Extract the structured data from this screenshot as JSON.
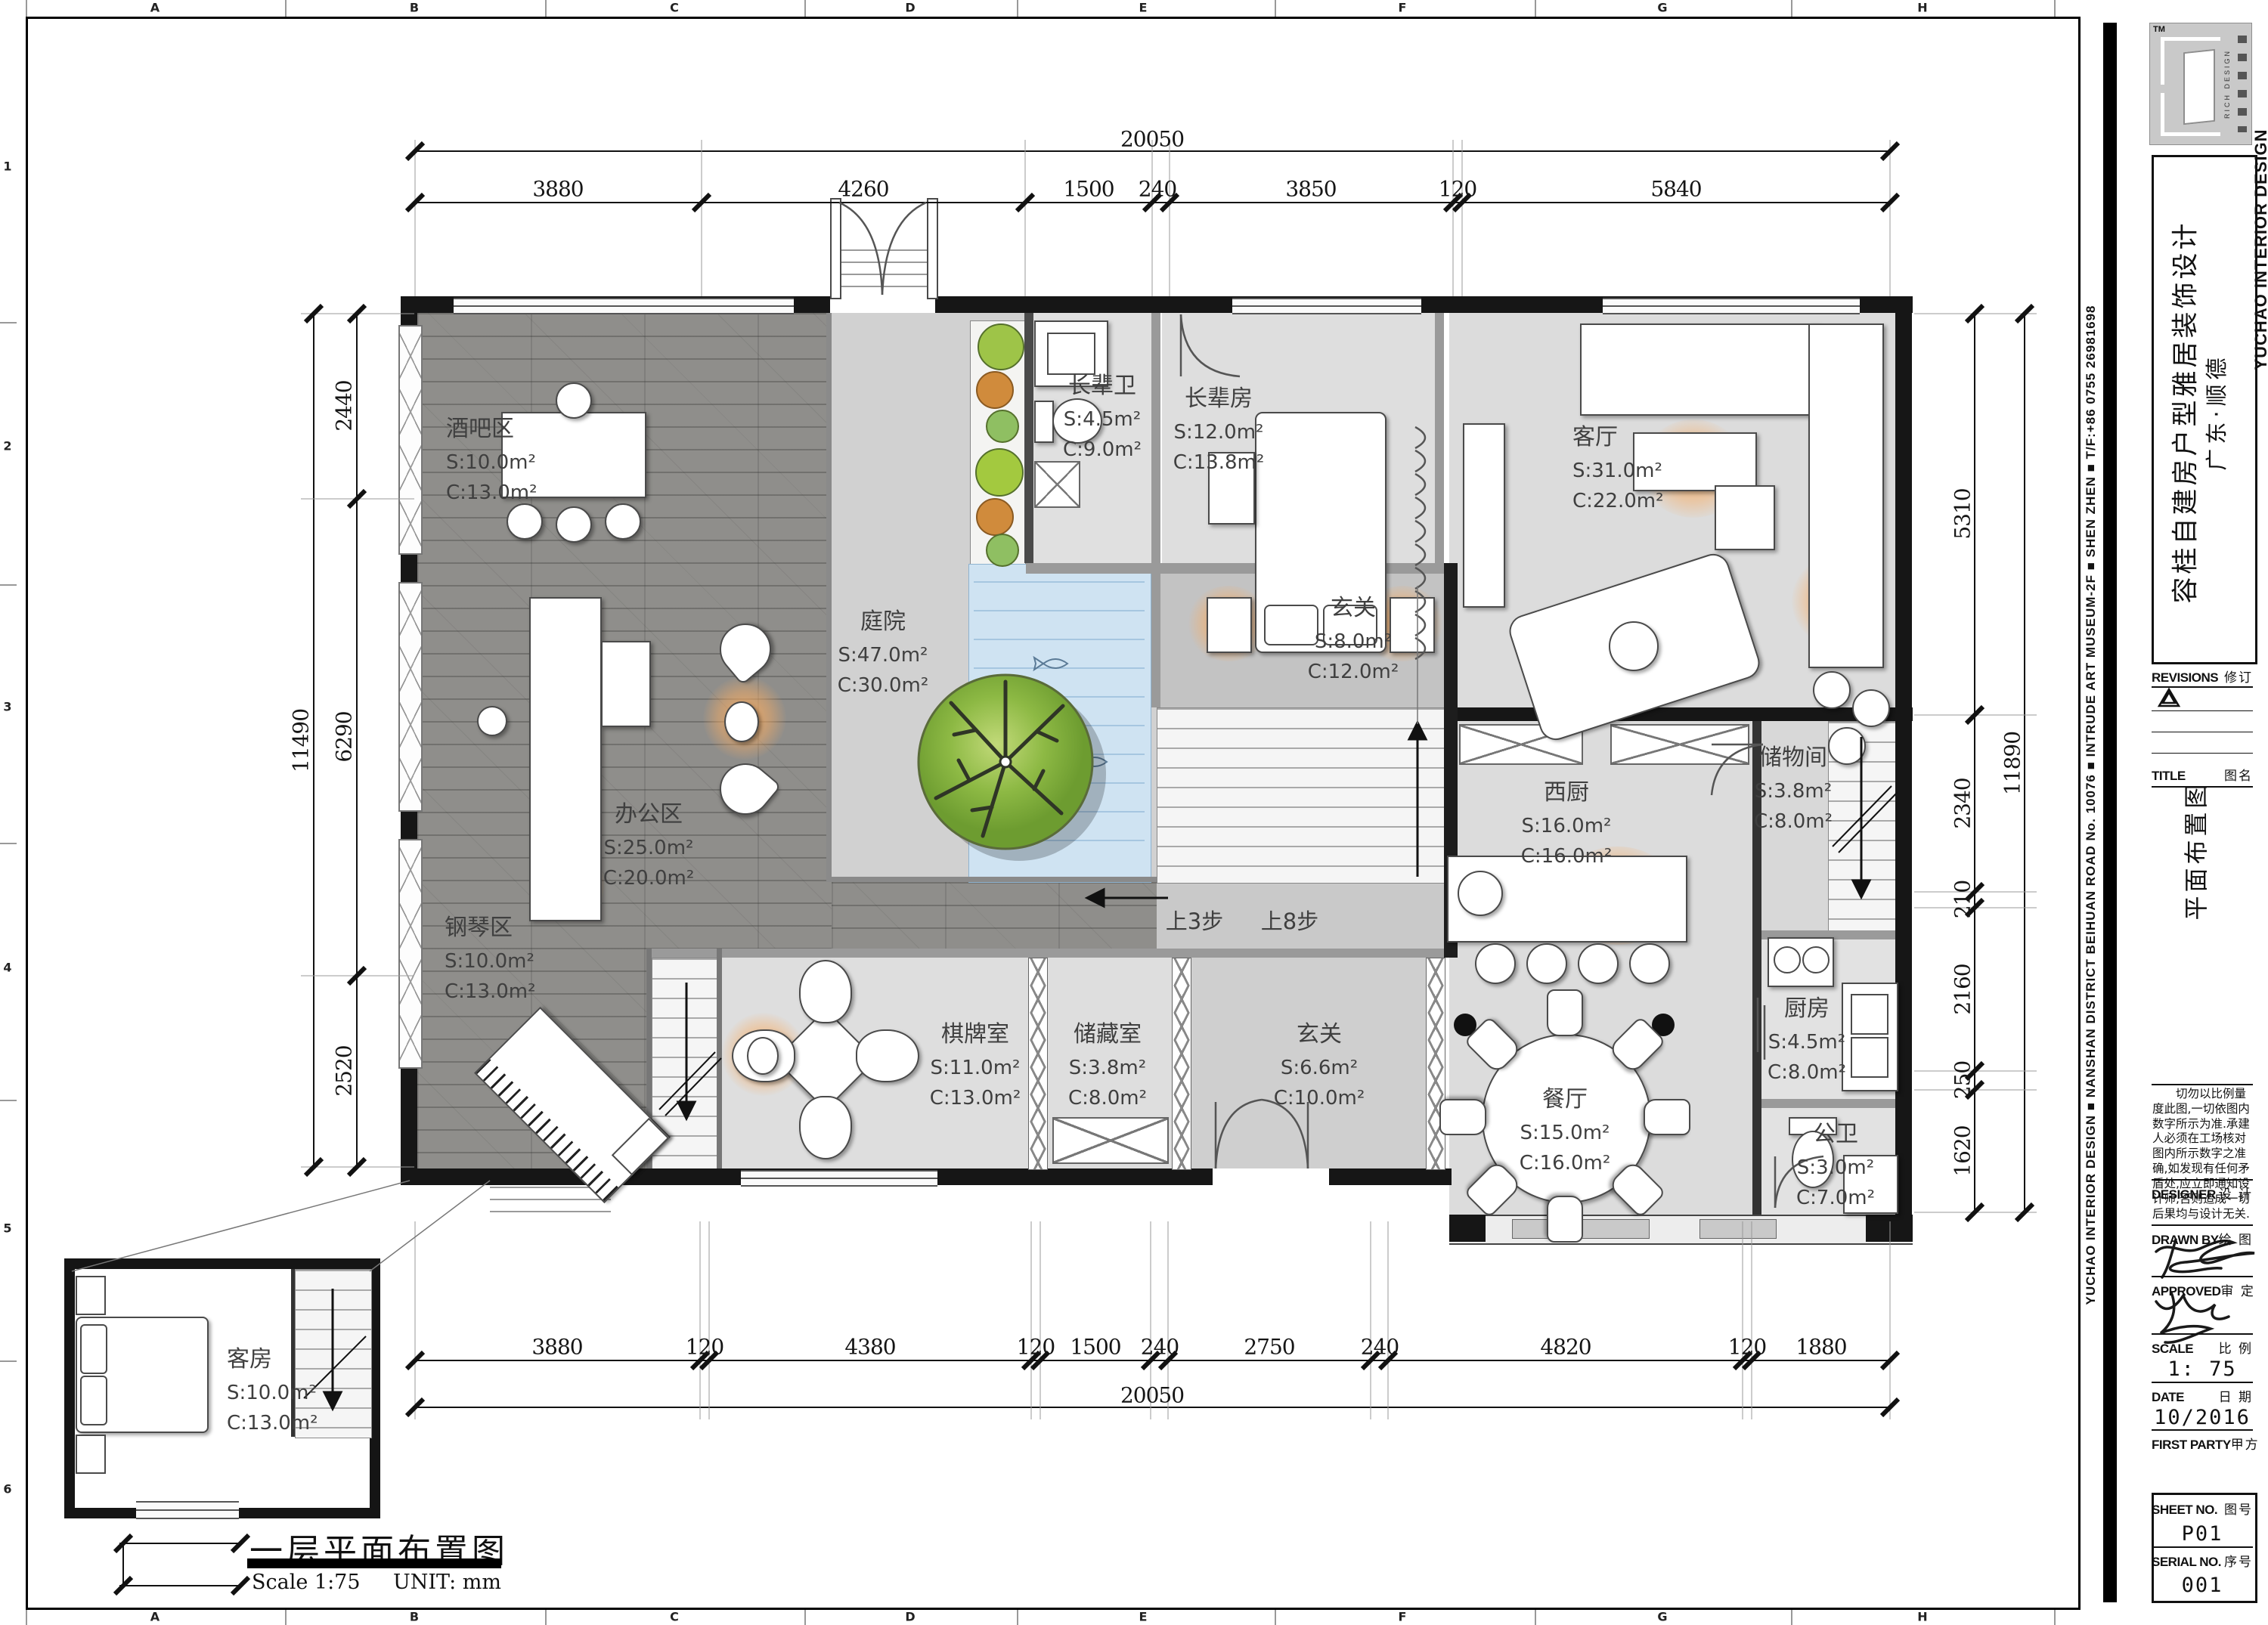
{
  "grid": {
    "letters": [
      "A",
      "B",
      "C",
      "D",
      "E",
      "F",
      "G",
      "H"
    ],
    "numbers": [
      "1",
      "2",
      "3",
      "4",
      "5",
      "6"
    ]
  },
  "strip": {
    "text": "YUCHAO INTERIOR DESIGN  ■  NANSHAN DISTRICT BEIHUAN ROAD No. 10076  ■  INTRUDE ART MUSEUM-2F  ■  SHEN ZHEN  ■  T/F:+86 0755 26981698"
  },
  "brand": {
    "name": "YUCHAO INTERIOR DESIGN",
    "rich": "RICH DESIGN",
    "tm": "TM"
  },
  "titleblock": {
    "project_line1": "容桂自建房户型雅居装饰设计",
    "project_line2": "广东·顺德",
    "revisions_en": "REVISIONS",
    "revisions_cn": "修订",
    "title_en": "TITLE",
    "title_cn": "图名",
    "drawing_name": "平面布置图",
    "note": "切勿以比例量度此图,一切依图内数字所示为准.承建人必须在工场核对图内所示数字之准确,如发现有任何矛盾处,应立即通知设计师,否则造成一切后果均与设计无关.",
    "designer_en": "DESIGNER",
    "designer_cn": "设 计",
    "drawn_en": "DRAWN BY",
    "drawn_cn": "绘 图",
    "approved_en": "APPROVED",
    "approved_cn": "审 定",
    "scale_en": "SCALE",
    "scale_cn": "比 例",
    "scale_value": "1: 75",
    "date_en": "DATE",
    "date_cn": "日 期",
    "date_value": "10/2016",
    "first_party_en": "FIRST PARTY",
    "first_party_cn": "甲方",
    "sheet_no_en": "SHEET NO.",
    "sheet_no_cn": "图号",
    "sheet_no_value": "P01",
    "serial_no_en": "SERIAL NO.",
    "serial_no_cn": "序号",
    "serial_no_value": "001"
  },
  "ptitle": {
    "name": "一层平面布置图",
    "scale": "Scale 1:75",
    "unit": "UNIT:  mm"
  },
  "labels": {
    "up3": "上3步",
    "up8": "上8步"
  },
  "dims": {
    "top_total": "20050",
    "top": [
      "3880",
      "4260",
      "1500",
      "240",
      "3850",
      "120",
      "5840"
    ],
    "bottom": [
      "3880",
      "120",
      "4380",
      "120",
      "1500",
      "240",
      "2750",
      "240",
      "4820",
      "120",
      "1880"
    ],
    "bottom_total": "20050",
    "left": [
      "2440",
      "6290",
      "2520"
    ],
    "left_total": "11490",
    "right": [
      "5310",
      "2340",
      "210",
      "2160",
      "250",
      "1620"
    ],
    "right_total": "11890"
  },
  "rooms": [
    {
      "name": "酒吧区",
      "s": "S:10.0m²",
      "c": "C:13.0m²"
    },
    {
      "name": "办公区",
      "s": "S:25.0m²",
      "c": "C:20.0m²"
    },
    {
      "name": "钢琴区",
      "s": "S:10.0m²",
      "c": "C:13.0m²"
    },
    {
      "name": "庭院",
      "s": "S:47.0m²",
      "c": "C:30.0m²"
    },
    {
      "name": "长辈卫",
      "s": "S:4.5m²",
      "c": "C:9.0m²"
    },
    {
      "name": "长辈房",
      "s": "S:12.0m²",
      "c": "C:13.8m²"
    },
    {
      "name": "客厅",
      "s": "S:31.0m²",
      "c": "C:22.0m²"
    },
    {
      "name": "玄关",
      "s": "S:8.0m²",
      "c": "C:12.0m²"
    },
    {
      "name": "西厨",
      "s": "S:16.0m²",
      "c": "C:16.0m²"
    },
    {
      "name": "储物间",
      "s": "S:3.8m²",
      "c": "C:8.0m²"
    },
    {
      "name": "厨房",
      "s": "S:4.5m²",
      "c": "C:8.0m²"
    },
    {
      "name": "餐厅",
      "s": "S:15.0m²",
      "c": "C:16.0m²"
    },
    {
      "name": "公卫",
      "s": "S:3.0m²",
      "c": "C:7.0m²"
    },
    {
      "name": "棋牌室",
      "s": "S:11.0m²",
      "c": "C:13.0m²"
    },
    {
      "name": "储藏室",
      "s": "S:3.8m²",
      "c": "C:8.0m²"
    },
    {
      "name": "玄关",
      "s": "S:6.6m²",
      "c": "C:10.0m²"
    },
    {
      "name": "客房",
      "s": "S:10.0m²",
      "c": "C:13.0m²"
    }
  ]
}
